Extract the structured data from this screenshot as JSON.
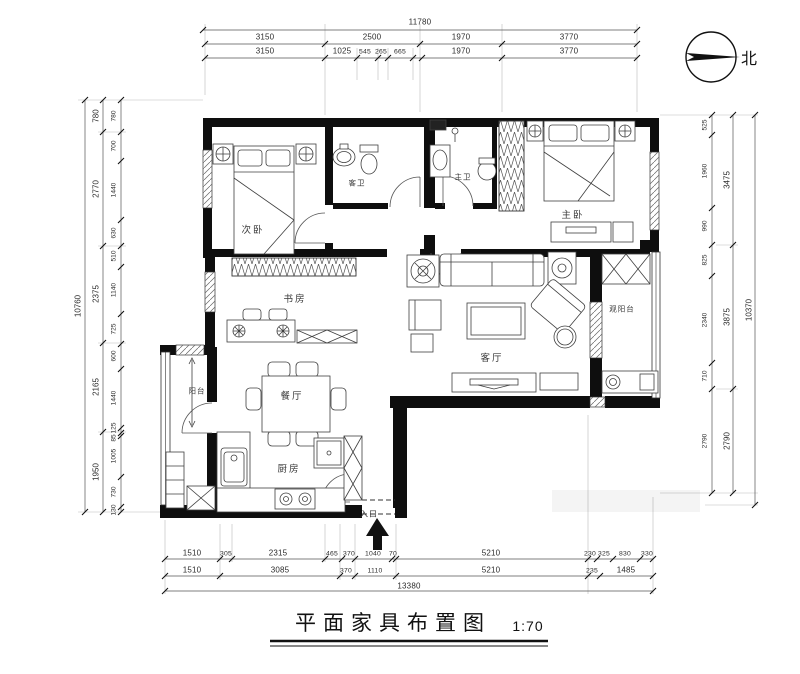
{
  "title_block": {
    "title": "平面家具布置图",
    "scale": "1:70"
  },
  "compass": {
    "label": "北"
  },
  "rooms": {
    "ciwo": "次卧",
    "kewei": "客卫",
    "zhuwei": "主卫",
    "zhuwo": "主卧",
    "shufang": "书房",
    "keting": "客厅",
    "guanyangtai": "观阳台",
    "canting": "餐厅",
    "yangtai": "阳台",
    "chufang": "厨房",
    "rukou": "入口"
  },
  "dimensions": {
    "top": {
      "total": "11780",
      "row1": [
        "3150",
        "2500",
        "1970",
        "3770"
      ],
      "row2": [
        "3150",
        "1025",
        "545",
        "265",
        "665",
        "1970",
        "3770"
      ]
    },
    "bottom": {
      "row1": [
        "1510",
        "305",
        "2315",
        "465",
        "370",
        "1040",
        "70",
        "5210",
        "230",
        "325",
        "830",
        "330"
      ],
      "row2": [
        "1510",
        "3085",
        "370",
        "1110",
        "5210",
        "235",
        "1485"
      ],
      "total": "13380"
    },
    "left": {
      "total": "10760",
      "mid": [
        "780",
        "2770",
        "2375",
        "2165",
        "1950"
      ],
      "inner": [
        "780",
        "700",
        "1440",
        "630",
        "510",
        "1140",
        "725",
        "600",
        "1440",
        "125",
        "85",
        "1005",
        "730",
        "130"
      ]
    },
    "right": {
      "total": "10370",
      "mid": [
        "3475",
        "3875",
        "2790"
      ],
      "inner": [
        "525",
        "1960",
        "990",
        "825",
        "2340",
        "710",
        "2790"
      ]
    }
  },
  "colors": {
    "wall": "#0e0e0e",
    "line": "#444444",
    "dim_text": "#2b2b2b"
  }
}
